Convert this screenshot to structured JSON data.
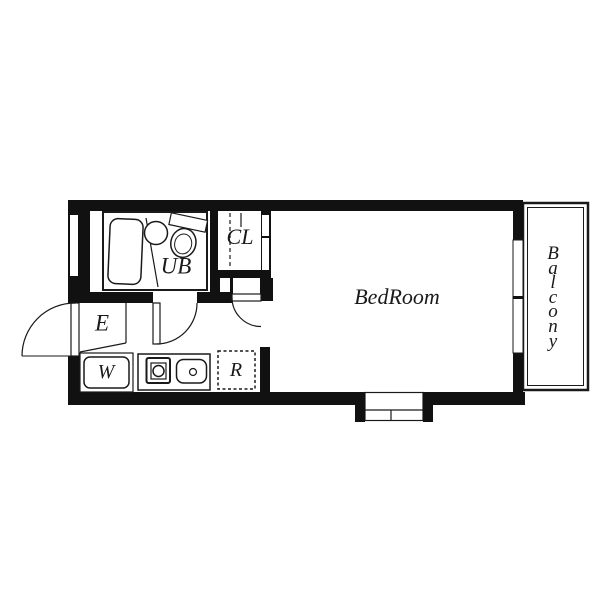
{
  "plan": {
    "colors": {
      "wall": "#111111",
      "line": "#1a1a1a",
      "bg": "#ffffff"
    },
    "rooms": {
      "bedroom": {
        "label": "BedRoom"
      },
      "balcony": {
        "label": "Balcony",
        "letters": [
          "B",
          "a",
          "l",
          "c",
          "o",
          "n",
          "y"
        ]
      },
      "unit_bath": {
        "label": "UB"
      },
      "closet": {
        "label": "CL"
      },
      "entrance": {
        "label": "E"
      },
      "washing_machine": {
        "label": "W"
      },
      "refrigerator": {
        "label": "R"
      }
    }
  }
}
